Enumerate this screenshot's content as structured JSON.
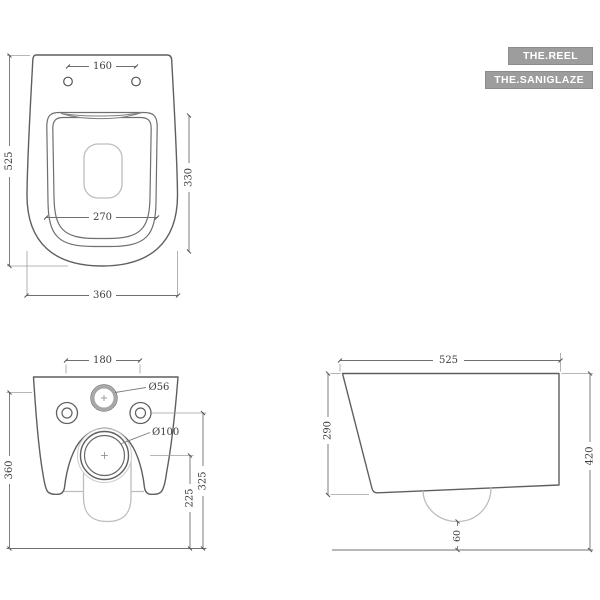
{
  "badges": {
    "primary": "THE.REEL",
    "secondary": "THE.SANIGLAZE"
  },
  "top_view": {
    "hole_spacing": "160",
    "depth_total": "525",
    "seat_depth": "330",
    "seat_width": "270",
    "width_total": "360"
  },
  "front_view": {
    "hole_spacing": "180",
    "inlet_diameter": "Ø56",
    "outlet_diameter": "Ø100",
    "height_total": "360",
    "inlet_height": "325",
    "outlet_height": "225"
  },
  "side_view": {
    "depth_total": "525",
    "front_height": "290",
    "height_total": "420",
    "outlet_bottom_clearance": "60"
  },
  "colors": {
    "line_dark": "#5f5f5f",
    "line_light": "#bdbdbd",
    "dimension": "#707070",
    "text": "#3e3e3e",
    "badge_bg": "#9d9d9d",
    "badge_text": "#ffffff"
  }
}
